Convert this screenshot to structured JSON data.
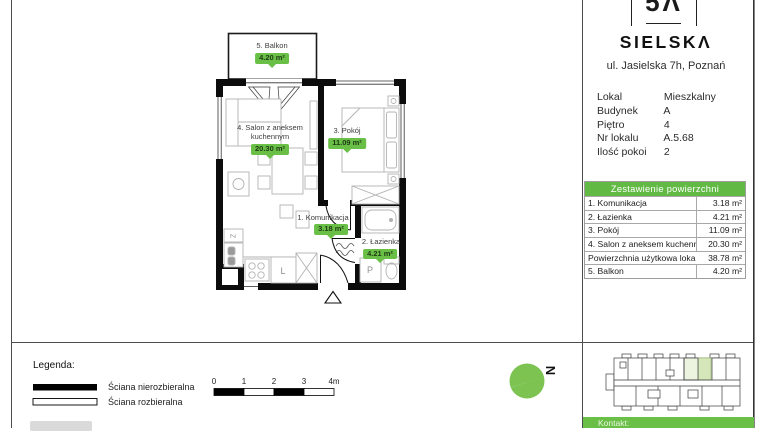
{
  "header": {
    "logo_monogram": "5Λ",
    "brand": "SIELSKΛ",
    "address": "ul. Jasielska 7h, Poznań"
  },
  "details": {
    "rows": [
      {
        "label": "Lokal",
        "value": "Mieszkalny"
      },
      {
        "label": "Budynek",
        "value": "A"
      },
      {
        "label": "Piętro",
        "value": "4"
      },
      {
        "label": "Nr lokalu",
        "value": "A.5.68"
      },
      {
        "label": "Ilość pokoi",
        "value": "2"
      }
    ]
  },
  "area_table": {
    "title": "Zestawienie powierzchni",
    "rows": [
      {
        "label": "1. Komunikacja",
        "value": "3.18 m²"
      },
      {
        "label": "2. Łazienka",
        "value": "4.21 m²"
      },
      {
        "label": "3. Pokój",
        "value": "11.09 m²"
      },
      {
        "label": "4. Salon z aneksem kuchennym",
        "value": "20.30 m²"
      },
      {
        "label": "Powierzchnia użytkowa lokalu",
        "value": "38.78 m²"
      },
      {
        "label": "5. Balkon",
        "value": "4.20 m²"
      }
    ]
  },
  "floorplan": {
    "rooms": [
      {
        "name": "5. Balkon",
        "area": "4.20 m²"
      },
      {
        "name": "4. Salon z aneksem kuchennym",
        "area": "20.30 m²"
      },
      {
        "name": "3. Pokój",
        "area": "11.09 m²"
      },
      {
        "name": "1. Komunikacja",
        "area": "3.18 m²"
      },
      {
        "name": "2. Łazienka",
        "area": "4.21 m²"
      }
    ],
    "appliance_labels": {
      "fridge": "L",
      "washer": "P",
      "cabinet": "Z"
    }
  },
  "legend": {
    "title": "Legenda:",
    "items": [
      {
        "label": "Ściana nierozbieralna"
      },
      {
        "label": "Ściana rozbieralna"
      }
    ]
  },
  "scalebar": {
    "labels": [
      "0",
      "1",
      "2",
      "3",
      "4m"
    ]
  },
  "compass": {
    "label": "N"
  },
  "footer": {
    "contact_label": "Kontakt:"
  },
  "colors": {
    "accent_green": "#6abf47",
    "table_header_green": "#62ba45",
    "compass_green": "#7cc351",
    "minimap_highlight": "#d5e7ba",
    "wall_black": "#0c0c0c"
  }
}
